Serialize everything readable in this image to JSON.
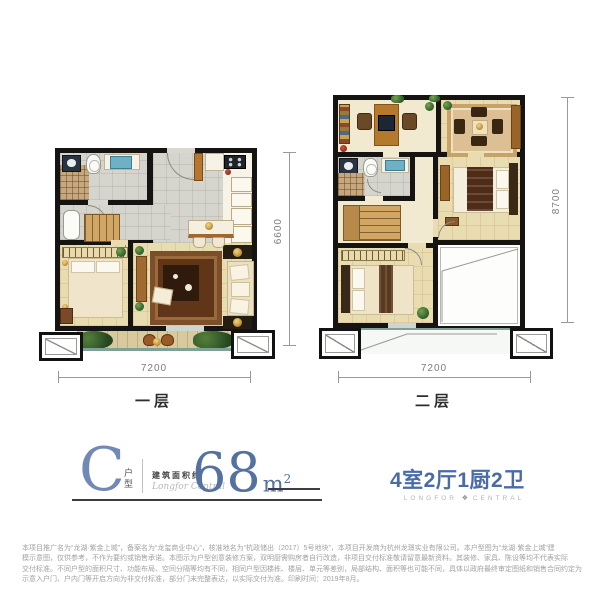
{
  "plans": {
    "floor1": {
      "label": "一层",
      "width_dim": "7200",
      "height_dim": "6600"
    },
    "floor2": {
      "label": "二层",
      "width_dim": "7200",
      "height_dim": "8700"
    }
  },
  "title_block": {
    "type_letter": "C",
    "type_word_1": "户",
    "type_word_2": "型",
    "area_prefix": "建筑面积约",
    "script": "Longfor Central",
    "area_value": "68",
    "area_unit": "m",
    "area_exponent": "2",
    "layout": "4室2厅1厨2卫",
    "brand_left": "LONGFOR",
    "brand_right": "CENTRAL"
  },
  "icons": {
    "brand_logo": "❖"
  },
  "colors": {
    "accent_blue": "#4a6ca6",
    "title_blue": "#7289b8",
    "area_blue": "#54719f",
    "wall_black": "#161412"
  },
  "disclaimer": {
    "line1": "本项目推广名为“龙湖·紫金上城”，备案名为“龙玺商业中心”，核准地名为“杭政储出（2017）5号地块”，本项目开发商为杭州龙璟实业有限公司。本户型图为“龙湖·紫金上城”建",
    "line2": "模示意图，仅供参考，不作为要约或销售承诺。本图示为户型创意装修方案，双明厨需购房者自行改造，非项目交付标准敬请留意最新资料。其装修、家具、陈设等均不代表实际",
    "line3": "交付标准。不同户型的面积尺寸、功能布局、空间分隔等均有不同，相同户型因楼栋、楼层、单元等差别，局部结构、面积等也可能不同，具体以政府最终审定图纸和销售合同约定为准。本图",
    "line4": "示意入户门、户内门等开启方向为非交付标准，部分门未完整表达，以实际交付为准。印刷时间：2019年8月。"
  }
}
